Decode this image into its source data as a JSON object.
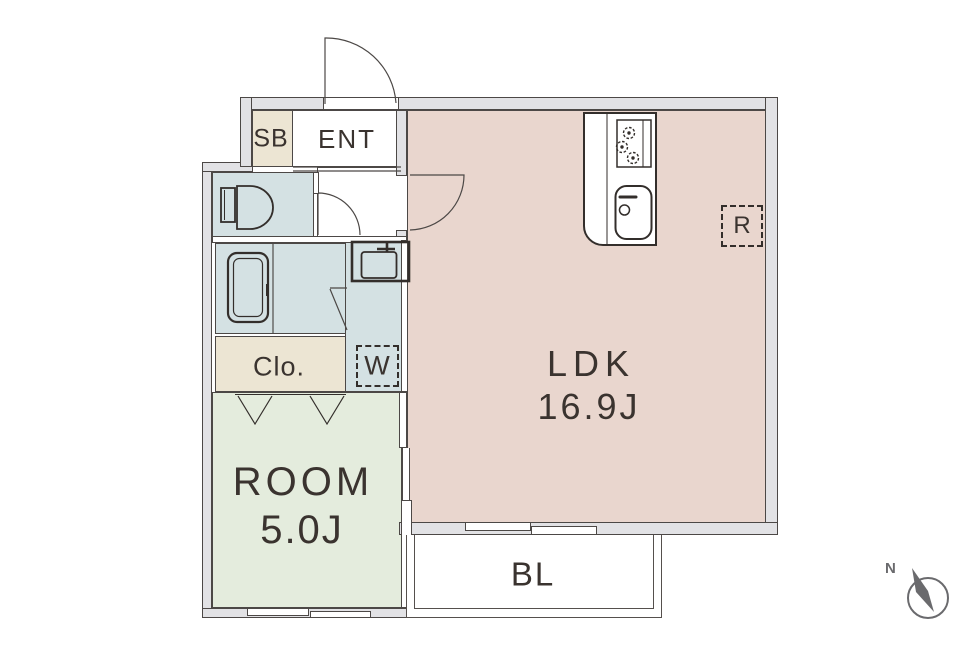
{
  "plan": {
    "rooms": {
      "ldk": {
        "label": "LDK",
        "area": "16.9J"
      },
      "bedroom": {
        "label": "ROOM",
        "area": "5.0J"
      },
      "entrance": {
        "label": "ENT"
      },
      "shoe_box": {
        "label": "SB"
      },
      "closet": {
        "label": "Clo."
      },
      "balcony": {
        "label": "BL"
      }
    },
    "fixtures": {
      "washing_machine_space": {
        "label": "W"
      },
      "refrigerator_space": {
        "label": "R"
      }
    },
    "compass": {
      "north": "N"
    }
  },
  "colors": {
    "ldk": "#e9d6ce",
    "bedroom": "#e4ecdd",
    "wet": "#d4e1e3",
    "storage": "#ece5d3",
    "wall-fill": "#e2e2e5",
    "wall-line": "#4c4846",
    "icon-line": "#332e2b",
    "label-text": "#3a332f",
    "compass": "#6a6a6d",
    "balcony-line": "#55504d"
  }
}
